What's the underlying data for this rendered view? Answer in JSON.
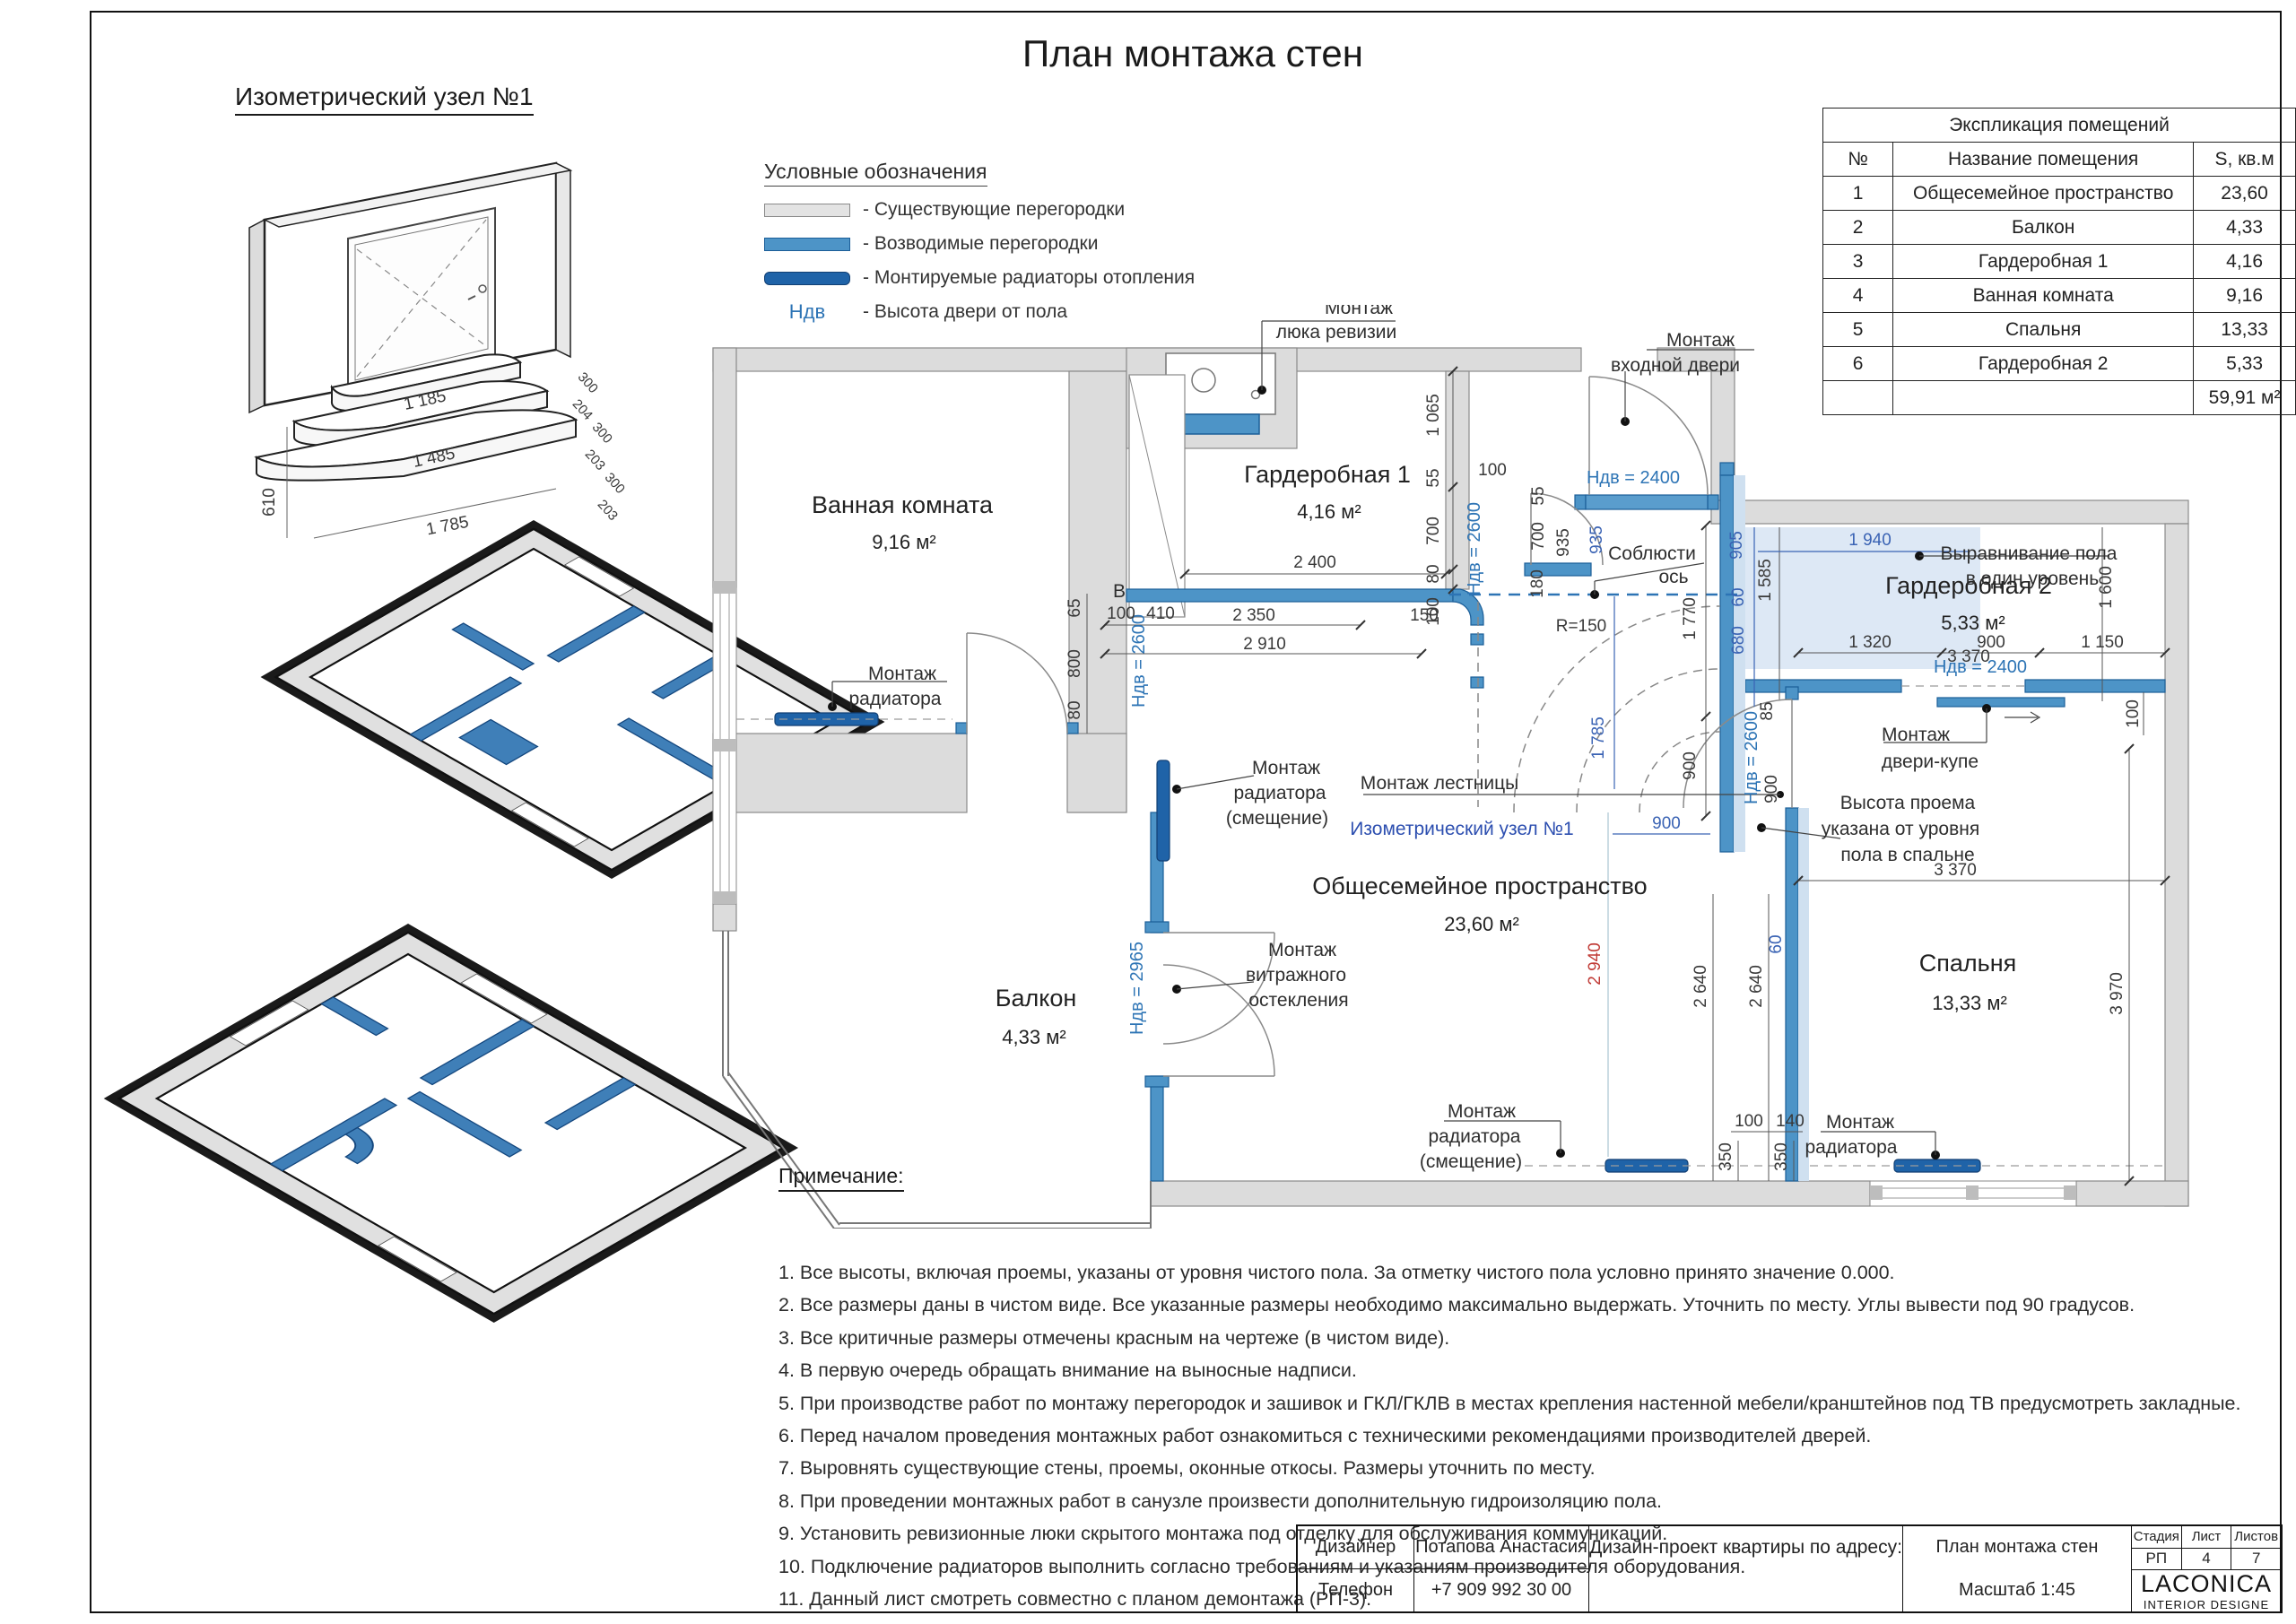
{
  "sheet": {
    "title": "План монтажа стен"
  },
  "iso_node": {
    "title": "Изометрический узел №1",
    "dims": [
      "1 185",
      "1 485",
      "1 785",
      "610",
      "300",
      "204",
      "300",
      "203",
      "300",
      "203"
    ]
  },
  "legend": {
    "title": "Условные обозначения",
    "ndv_term": "Ндв",
    "items": [
      "- Существующие перегородки",
      "- Возводимые перегородки",
      "- Монтируемые радиаторы отопления",
      "- Высота двери от пола"
    ]
  },
  "explication": {
    "title": "Экспликация помещений",
    "col_num": "№",
    "col_name": "Название помещения",
    "col_area": "S, кв.м",
    "rows": [
      [
        "1",
        "Общесемейное пространство",
        "23,60"
      ],
      [
        "2",
        "Балкон",
        "4,33"
      ],
      [
        "3",
        "Гардеробная 1",
        "4,16"
      ],
      [
        "4",
        "Ванная комната",
        "9,16"
      ],
      [
        "5",
        "Спальня",
        "13,33"
      ],
      [
        "6",
        "Гардеробная 2",
        "5,33"
      ]
    ],
    "total": "59,91 м²"
  },
  "plan": {
    "rooms": [
      {
        "name": "Ванная комната",
        "area": "9,16 м²"
      },
      {
        "name": "Гардеробная 1",
        "area": "4,16 м²"
      },
      {
        "name": "Гардеробная 2",
        "area": "5,33 м²"
      },
      {
        "name": "Общесемейное пространство",
        "area": "23,60 м²"
      },
      {
        "name": "Балкон",
        "area": "4,33 м²"
      },
      {
        "name": "Спальня",
        "area": "13,33 м²"
      }
    ],
    "labels": [
      "Монтаж",
      "люка ревизии",
      "Монтаж",
      "входной двери",
      "Выравнивание пола",
      "в один уровень",
      "Соблюсти",
      "ось",
      "Монтаж",
      "радиатора",
      "Монтаж",
      "радиатора",
      "(смещение)",
      "Монтаж лестницы",
      "Изометрический узел №1",
      "Монтаж",
      "витражного",
      "остекления",
      "Монтаж",
      "радиатора",
      "(смещение)",
      "Монтаж",
      "радиатора",
      "Монтаж",
      "двери-купе",
      "Высота проема",
      "указана от уровня",
      "пола в спальне",
      "В"
    ],
    "ndv": [
      "Ндв = 2400",
      "Ндв = 2600",
      "Ндв = 2600",
      "Ндв = 2600",
      "Ндв = 2965",
      "Ндв = 2400"
    ],
    "dims": {
      "g1_chain": [
        "1 065",
        "55",
        "700",
        "80",
        "100"
      ],
      "g1_width": "2 400",
      "bath_door": [
        "100",
        "410",
        "2 350",
        "150",
        "2 910"
      ],
      "bath_chain": [
        "65",
        "800",
        "80"
      ],
      "top_small": "100",
      "entr_chain": [
        "55",
        "700",
        "935",
        "180"
      ],
      "entr_blue": "935",
      "hall_v": [
        "1 770",
        "900"
      ],
      "hall_blue": [
        "1 785",
        "900"
      ],
      "g2_blue": [
        "905",
        "60",
        "680",
        "1 940"
      ],
      "g2_black": [
        "1 585",
        "1 600",
        "3 370",
        "1 320",
        "900",
        "1 150",
        "100"
      ],
      "bed_door": [
        "85",
        "900"
      ],
      "bed": [
        "3 370",
        "3 970",
        "2 640",
        "2 640",
        "100",
        "140",
        "350",
        "350"
      ],
      "bed_blue60": "60",
      "red": "2 940",
      "r150": "R=150"
    }
  },
  "notes": {
    "title": "Примечание:",
    "items": [
      "1. Все высоты, включая проемы, указаны от уровня чистого пола. За отметку чистого пола условно принято значение 0.000.",
      "2. Все размеры даны в чистом виде. Все указанные размеры необходимо максимально выдержать. Уточнить по месту. Углы вывести под 90 градусов.",
      "3. Все критичные размеры отмечены красным на чертеже (в чистом виде).",
      "4. В первую очередь обращать внимание на выносные надписи.",
      "5. При производстве работ по монтажу перегородок и зашивок и ГКЛ/ГКЛВ в местах крепления настенной мебели/кранштейнов под ТВ предусмотреть закладные.",
      "6. Перед началом проведения монтажных работ ознакомиться с техническими рекомендациями производителей дверей.",
      "7. Выровнять существующие стены, проемы, оконные откосы. Размеры уточнить по месту.",
      "8. При проведении монтажных работ в санузле произвести дополнительную гидроизоляцию пола.",
      "9. Установить ревизионные люки скрытого монтажа под отделку для обслуживания коммуникаций.",
      "10. Подключение радиаторов выполнить согласно требованиям и указаниям производителя оборудования.",
      "11. Данный лист смотреть совместно с планом демонтажа (РП-3)."
    ]
  },
  "titleblock": {
    "designer_label": "Дизайнер",
    "designer": "Потапова Анастасия",
    "phone_label": "Телефон",
    "phone": "+7 909 992 30 00",
    "project": "Дизайн-проект квартиры по адресу:",
    "sheet_name": "План монтажа стен",
    "scale": "Масштаб 1:45",
    "stage_label": "Стадия",
    "sheet_label": "Лист",
    "sheets_label": "Листов",
    "stage": "РП",
    "sheet_num": "4",
    "sheets_total": "7",
    "brand": "LACONICA",
    "brand_sub": "INTERIOR DESIGNE"
  }
}
